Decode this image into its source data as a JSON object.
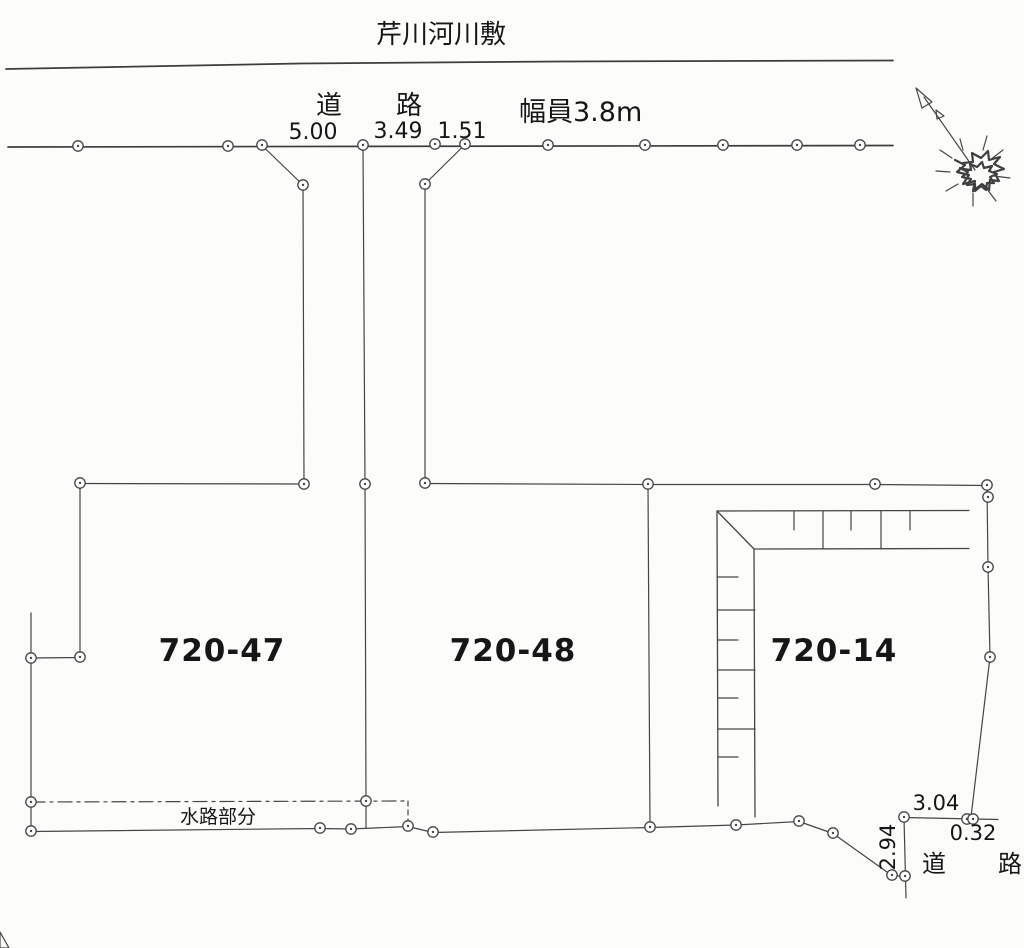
{
  "page": {
    "background": "#fcfcfa",
    "line_color": "#454545",
    "text_color": "#161616"
  },
  "labels": {
    "river": "芹川河川敷",
    "road_top": "道　路",
    "road_width": "幅員3.8m",
    "waterway": "水路部分",
    "road_bottom": "道　路"
  },
  "measurements": {
    "top": [
      "5.00",
      "3.49",
      "1.51"
    ],
    "bottom_right": {
      "east": "3.04",
      "offset": "0.32",
      "south": "2.94"
    }
  },
  "parcels": [
    {
      "id": "720-47"
    },
    {
      "id": "720-48"
    },
    {
      "id": "720-14"
    }
  ],
  "icons": {
    "north_arrow": "north-arrow"
  }
}
